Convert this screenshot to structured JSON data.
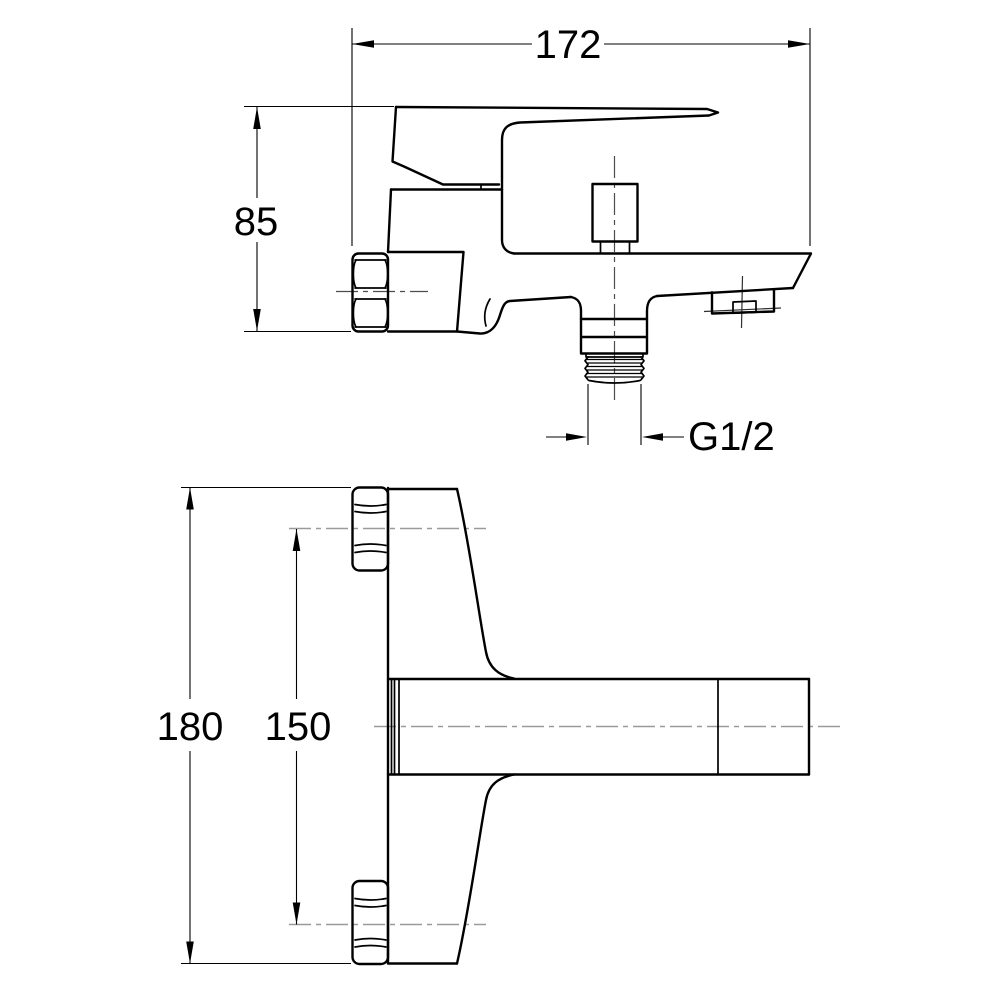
{
  "diagram": {
    "type": "technical-drawing",
    "subject": "bath-shower-mixer-faucet",
    "labels": {
      "spout_reach": "172",
      "deck_height": "85",
      "outlet_thread": "G1/2",
      "overall_height": "180",
      "connection_centers": "150"
    },
    "colors": {
      "background": "#ffffff",
      "line": "#000000",
      "centerline": "#9a9a9a"
    }
  }
}
